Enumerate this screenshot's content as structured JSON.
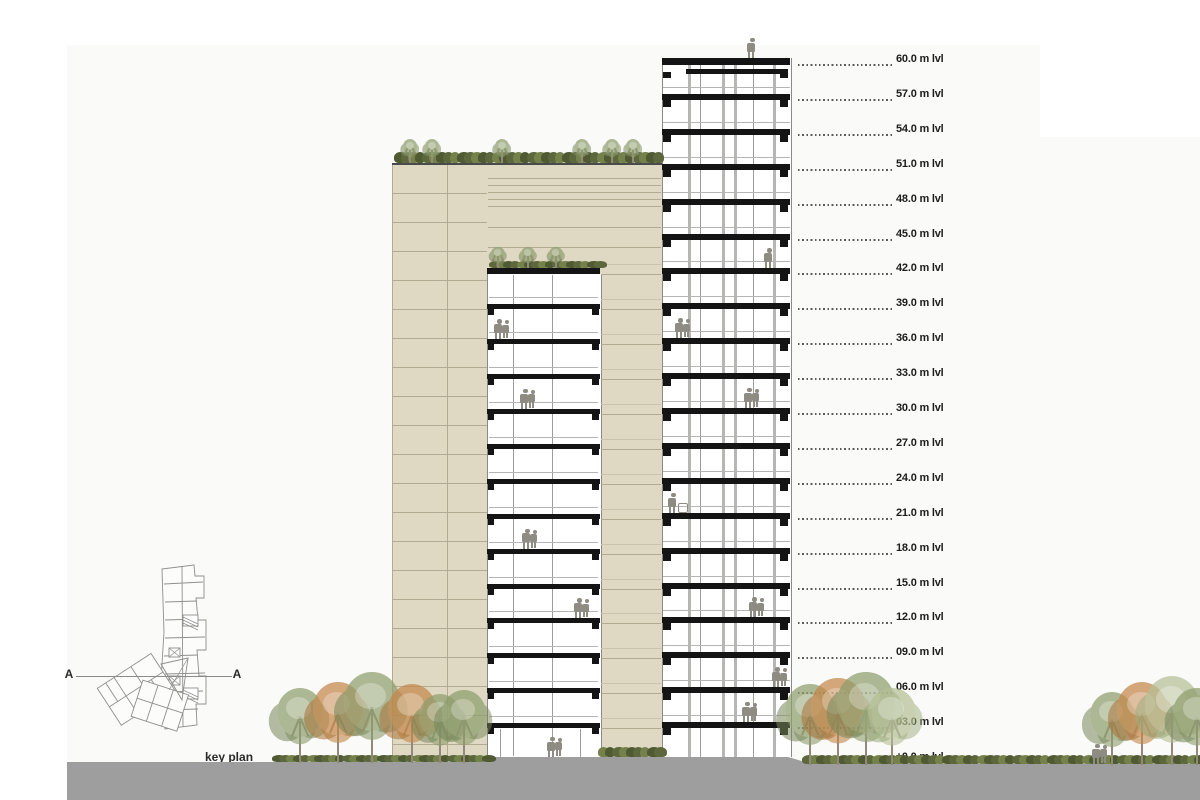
{
  "drawing": {
    "type": "architectural-section-elevation",
    "levels": [
      {
        "label": "60.0 m lvl",
        "meters": 60
      },
      {
        "label": "57.0 m lvl",
        "meters": 57
      },
      {
        "label": "54.0 m lvl",
        "meters": 54
      },
      {
        "label": "51.0 m lvl",
        "meters": 51
      },
      {
        "label": "48.0 m lvl",
        "meters": 48
      },
      {
        "label": "45.0 m lvl",
        "meters": 45
      },
      {
        "label": "42.0 m lvl",
        "meters": 42
      },
      {
        "label": "39.0 m lvl",
        "meters": 39
      },
      {
        "label": "36.0 m lvl",
        "meters": 36
      },
      {
        "label": "33.0 m lvl",
        "meters": 33
      },
      {
        "label": "30.0 m lvl",
        "meters": 30
      },
      {
        "label": "27.0 m lvl",
        "meters": 27
      },
      {
        "label": "24.0 m lvl",
        "meters": 24
      },
      {
        "label": "21.0 m lvl",
        "meters": 21
      },
      {
        "label": "18.0 m lvl",
        "meters": 18
      },
      {
        "label": "15.0 m lvl",
        "meters": 15
      },
      {
        "label": "12.0 m lvl",
        "meters": 12
      },
      {
        "label": "09.0 m lvl",
        "meters": 9
      },
      {
        "label": "06.0 m lvl",
        "meters": 6
      },
      {
        "label": "03.0 m lvl",
        "meters": 3
      },
      {
        "label": "±0.0 m lvl",
        "meters": 0
      }
    ],
    "key_plan": {
      "label": "key plan",
      "section_marker_left": "A",
      "section_marker_right": "A"
    },
    "colors": {
      "paper": "#fafaf8",
      "wall_beige": "#dfd9c3",
      "joint": "#b2ab92",
      "slab": "#141414",
      "column_gray": "#b6b6b4",
      "mullion": "#9c9c9a",
      "ground": "#9e9e9e",
      "tree_green": "#8d9c6c",
      "tree_green_dark": "#76865a",
      "tree_pale": "#b4bf95",
      "tree_pale_dark": "#9dab7d",
      "tree_orange": "#c3874a",
      "tree_orange_dark": "#aa7338",
      "bush_a": "#5c673c",
      "bush_b": "#75814b",
      "bush_c": "#4f5a33",
      "trunk": "#93897a",
      "person": "#8e8b82",
      "text": "#1c1c1c",
      "leader": "#5a5a5a",
      "plan_line": "#8f8f8f"
    }
  }
}
